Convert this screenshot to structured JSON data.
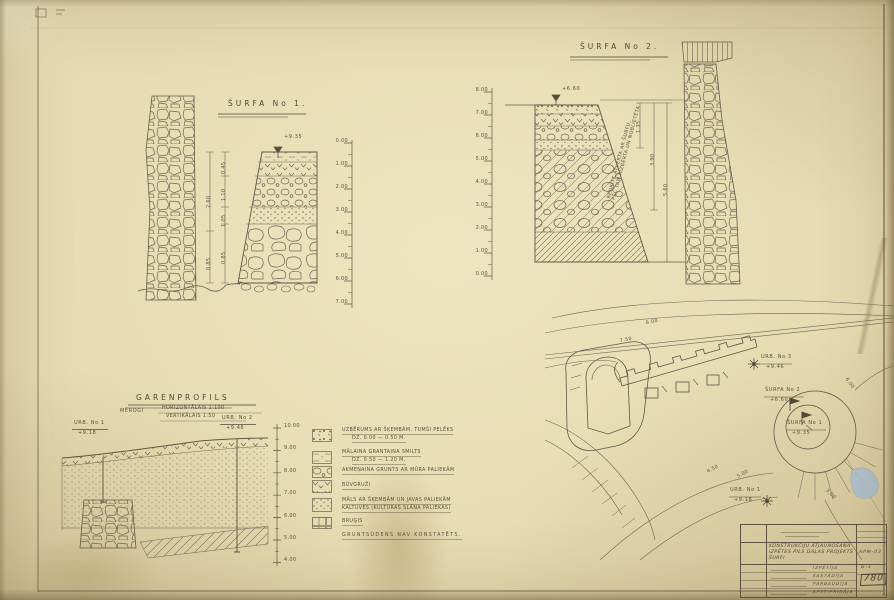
{
  "surfa1": {
    "title": "ŠURFA No 1.",
    "elevation": "+9.35",
    "scale": [
      "0.00",
      "1.00",
      "2.00",
      "3.00",
      "4.00",
      "5.00",
      "6.00",
      "7.00"
    ],
    "dims": [
      "0.45",
      "1.10",
      "1.05",
      "0.85"
    ],
    "dims_outer": [
      "2.60",
      "0.85"
    ]
  },
  "surfa2": {
    "title": "ŠURFA No 2.",
    "elevation": "+6.60",
    "scale": [
      "8.00",
      "7.00",
      "6.00",
      "5.00",
      "4.00",
      "3.00",
      "2.00",
      "1.00",
      "0.00"
    ],
    "note1": "BEDRĪTE ATVĒRTA AR ŠURFU,",
    "note2": "PĒC TAM AIZBĒRTA UN NOBLIETĒTA",
    "dims": [
      "1.35",
      "3.90",
      "5.60"
    ]
  },
  "profile": {
    "title": "GARENPROFILS",
    "merogi": "MĒROGI",
    "scale_h": "HORIZONTĀLAIS 1:100",
    "scale_v": "VERTIKĀLAIS 1:50",
    "left_name": "URB. No 1",
    "left_elev": "+9.18",
    "right_name": "URB. No 2",
    "right_elev": "+9.46",
    "scale": [
      "10.00",
      "9.00",
      "8.00",
      "7.00",
      "6.00",
      "5.00",
      "4.00"
    ]
  },
  "legend": {
    "items": [
      {
        "l1": "UZBĒRUMS AR ŠĶEMBĀM, TUMŠI PELĒKS",
        "l2": "DZ. 0.00 — 0.50 M."
      },
      {
        "l1": "MĀLAINA GRANTAINA SMILTS",
        "l2": "DZ. 0.50 — 1.20 M."
      },
      {
        "l1": "AKMEŅAINA GRUNTS AR MŪRA PALIEKĀM",
        "l2": ""
      },
      {
        "l1": "BŪVGRUŽI",
        "l2": ""
      },
      {
        "l1": "MĀLS AR ŠĶEMBĀM UN JAVAS PALIEKĀM",
        "l2": "KALTUVES (KULTŪRAS SLĀŅA PALIEKAS)"
      },
      {
        "l1": "BRUĢIS",
        "l2": ""
      }
    ],
    "note": "GRUNTSŪDENS NAV KONSTATĒTS."
  },
  "plan": {
    "points": [
      {
        "name": "URB. No 3",
        "elev": "+9.46"
      },
      {
        "name": "ŠURFA No 2",
        "elev": "+6.60"
      },
      {
        "name": "ŠURFA No 1",
        "elev": "+9.35"
      },
      {
        "name": "URB. No 1",
        "elev": "+9.18"
      }
    ],
    "contours": [
      "8.00",
      "7.50",
      "6.00",
      "5.00",
      "4.50",
      "3.00"
    ]
  },
  "titleblock": {
    "line1": "KONSTRUKCIJU ATJAUNOŠANA",
    "line2": "IZPĒTES PILS DAĻAS PROJEKTS",
    "line3": "ŠURFI",
    "code": "APM-03",
    "roles": [
      "IZPĒTĪJA",
      "SASTĀDĪJA",
      "PĀRBAUDĪJA",
      "APSTIPRINĀJA"
    ],
    "series": "G-1",
    "number": "780"
  }
}
